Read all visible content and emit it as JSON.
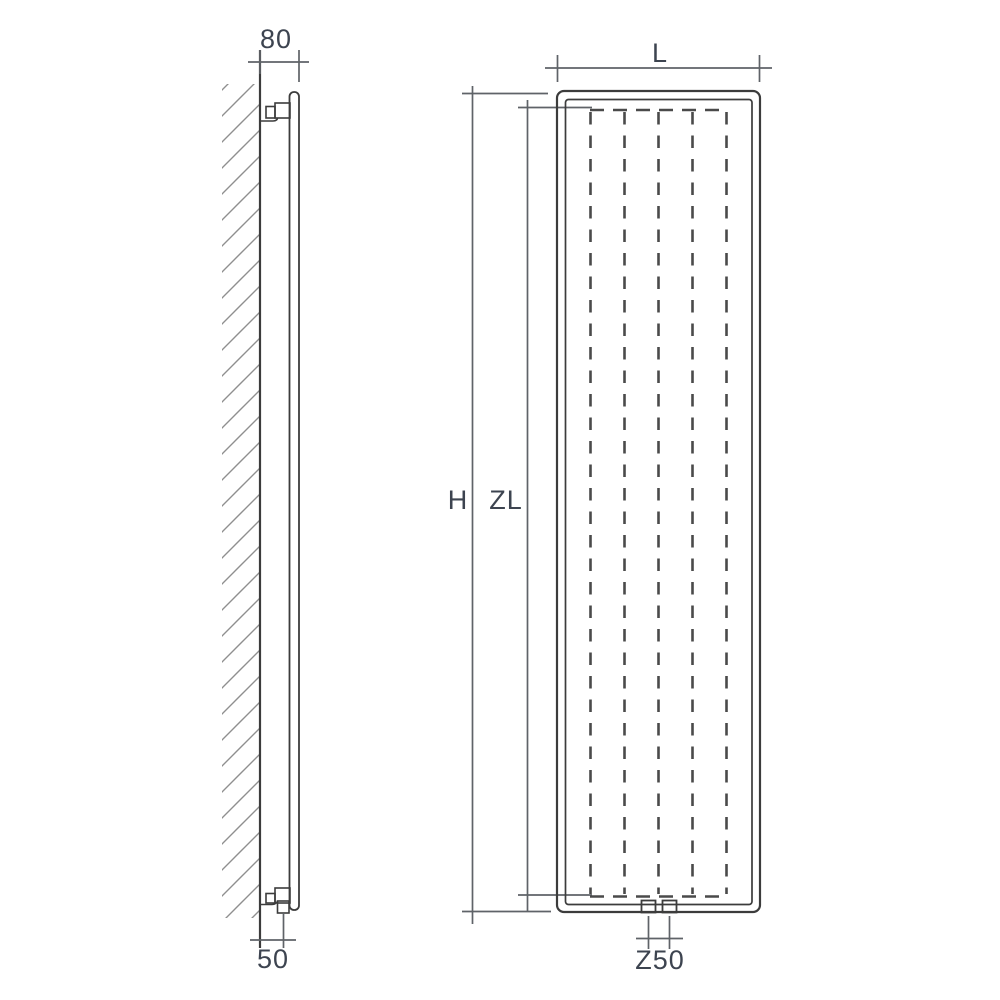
{
  "drawing": {
    "title": "radiator-technical-dimension-drawing",
    "side_view": {
      "name": "wall-mounted-side-profile",
      "depth_dimension_label": "80",
      "connection_offset_label": "50"
    },
    "front_view": {
      "name": "radiator-front-elevation",
      "width_dimension_label": "L",
      "height_dimension_label": "H",
      "convector_height_label": "ZL",
      "connection_spacing_label": "Z50"
    },
    "colors": {
      "background": "#ffffff",
      "object_line": "#3c3c3c",
      "dimension_line": "#5f6368",
      "hatch_line": "#8f8f8f",
      "label_text": "#3d4450"
    }
  }
}
